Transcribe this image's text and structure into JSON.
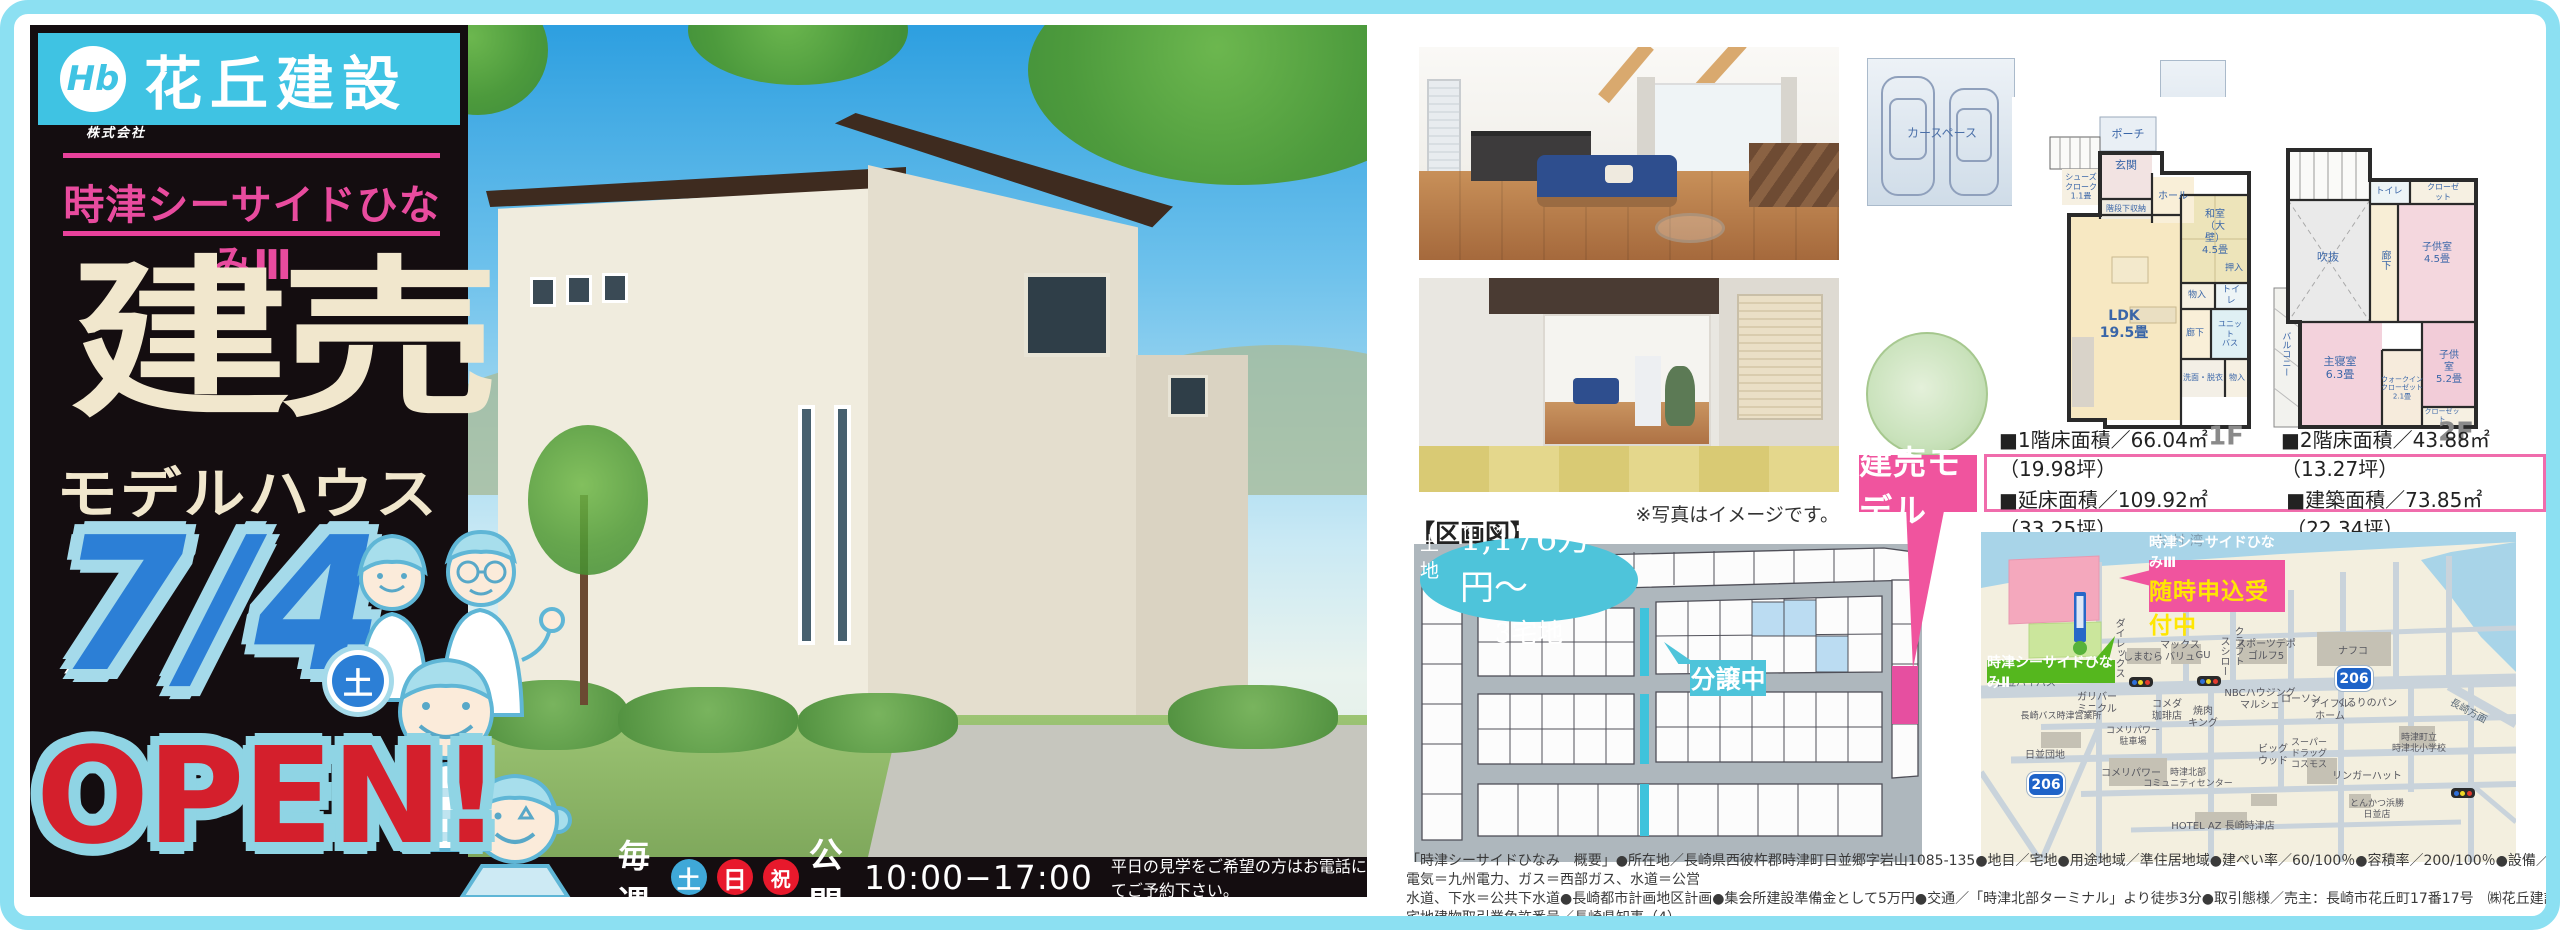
{
  "brand": {
    "company_type": "株式会社",
    "company": "花丘建設",
    "logo_mark": "Hb"
  },
  "hero": {
    "project": "時津シーサイドひなみⅢ",
    "title": "建売",
    "subtitle": "モデルハウス",
    "date": "7/4",
    "date_day": "土",
    "open": "OPEN!",
    "schedule": {
      "every": "毎週",
      "days": [
        "土",
        "日",
        "祝"
      ],
      "open_label": "公開",
      "hours": "10:00−17:00",
      "note": "平日の見学をご希望の方はお電話にてご予約下さい。"
    }
  },
  "photos": {
    "caption": "※写真はイメージです。"
  },
  "model": {
    "tag": "建売モデル",
    "areas": [
      "■1階床面積／66.04㎡（19.98坪）",
      "■2階床面積／43.88㎡（13.27坪）",
      "■延床面積／109.92㎡（33.25坪）",
      "■建築面積／73.85㎡（22.34坪）"
    ]
  },
  "plans": {
    "f1": {
      "label": "1F",
      "car_left": "カースペース",
      "car_right": "カースペース",
      "rooms": {
        "porch": "ポーチ",
        "entrance": "玄関",
        "shoes": "シューズ\nクローク\n1.1畳",
        "under_stairs": "階段下収納",
        "hall": "ホール",
        "washitsu": "和室（大壁）\n4.5畳",
        "oshiire": "押入",
        "mono1": "物入",
        "toilet": "トイレ",
        "ldk": "LDK\n19.5畳",
        "hallway": "廊下",
        "bath": "ユニット\nバス",
        "wash": "洗面・脱衣",
        "mono2": "物入"
      }
    },
    "f2": {
      "label": "2F",
      "rooms": {
        "void": "吹抜",
        "hallway": "廊下",
        "toilet": "トイレ",
        "closet1": "クローゼット",
        "kids1": "子供室\n4.5畳",
        "kids2": "子供室\n5.2畳",
        "master": "主寝室\n6.3畳",
        "wic": "ウォークイン\nクローゼット\n2.1畳",
        "closet2": "クローゼット",
        "balcony": "バルコニー"
      }
    }
  },
  "lot_map": {
    "title": "【区画図】",
    "price_prefix": "土地",
    "price": "1,176万円〜",
    "lots": "3宅地",
    "status": "分譲中"
  },
  "access_map": {
    "bay": "大村湾",
    "route": "206",
    "headline": "時津シーサイドひなみⅢ",
    "sub_headline": "随時申込受付中",
    "phase2": "時津シーサイドひなみⅡ",
    "pois": {
      "bypass": "日並バイパス",
      "direx": "ダイレックス",
      "shimamura": "しまむら",
      "maxvalu": "マックス\nバリュ",
      "gu": "GU",
      "sushiro": "スシロー",
      "craft": "クラフト",
      "sportsdepo": "スポーツデポ\nゴルフ5",
      "nafco": "ナフコ",
      "gulliver": "ガリバー\nミニクル",
      "komeda": "コメダ\n珈琲店",
      "yakiniku": "焼肉\nキング",
      "nbc": "NBCハウジング\nマルシェ",
      "lawson": "ローソン",
      "eyefulhome": "アイフル\nホーム",
      "kururi": "くるりのパン",
      "nagasaki": "長崎方面",
      "bus_office": "長崎バス時津営業所",
      "komeri_parking": "コメリパワー\n駐車場",
      "hinami_danchi": "日並団地",
      "komeri": "コメリパワー",
      "community": "時津北部\nコミュニティセンター",
      "bigwood": "ビッグ\nウッド",
      "cosmos": "スーパー\nドラッグ\nコスモス",
      "ringerhut": "リンガーハット",
      "school": "時津町立\n時津北小学校",
      "hamakatsu": "とんかつ浜勝\n日並店",
      "hotel": "HOTEL AZ 長崎時津店"
    }
  },
  "legal": {
    "line1": "「時津シーサイドひなみ　概要」●所在地／長崎県西彼杵郡時津町日並郷字岩山1085-135●地目／宅地●用途地域／準住居地域●建ぺい率／60/100％●容積率／200/100％●設備／電気＝九州電力、ガス＝西部ガス、水道＝公営",
    "line2": "水道、下水＝公共下水道●長崎都市計画地区計画●集会所建設準備金として5万円●交通／「時津北部ターミナル」より徒歩3分●取引態様／売主：長崎市花丘町17番17号　㈱花丘建設　宅地建物取引業免許番号／長崎県知事（4）",
    "line3": "第3414号　建設業許可番号：長崎県知事（般-30）第9618号●取引条件有効期限／令和2年7月31日"
  }
}
